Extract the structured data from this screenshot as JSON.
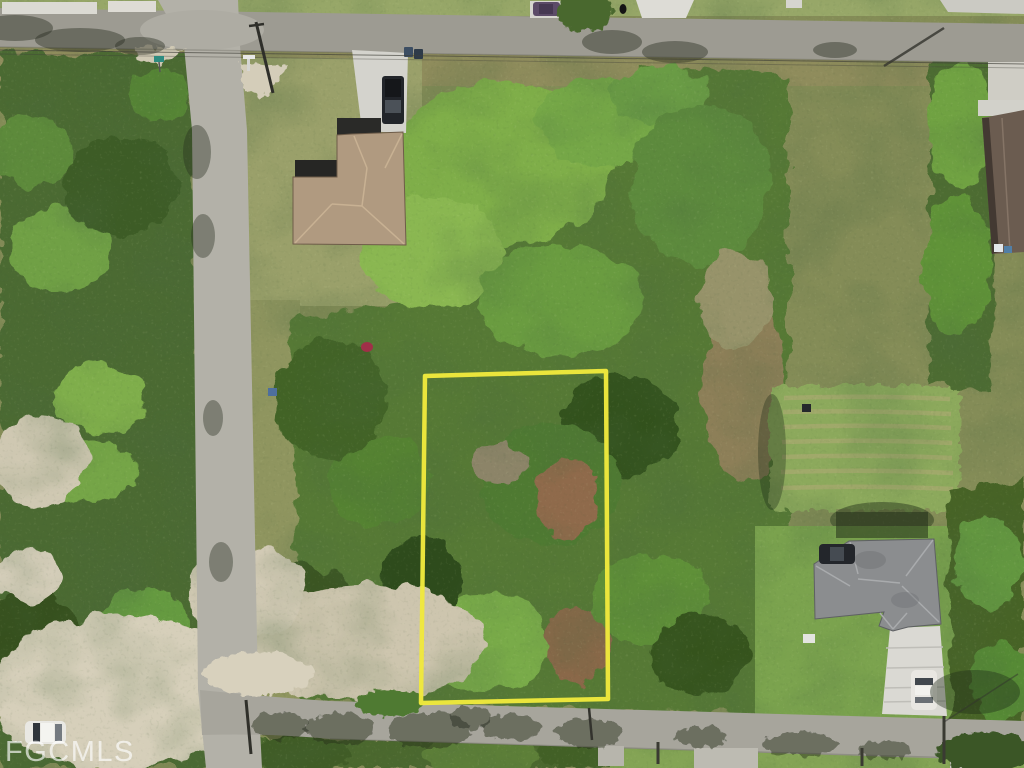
{
  "photo": {
    "watermark_text": "FGCMLS",
    "caption": "Aerial drone view of a wooded vacant residential lot outlined in yellow between two streets"
  },
  "boundary": {
    "label": "highlighted lot boundary",
    "color": "#f0e83d"
  },
  "colors": {
    "watermark": "#ffffff"
  },
  "scene": {
    "roads": [
      "street-top",
      "street-left",
      "street-bottom"
    ],
    "houses": [
      "tan-roof-house",
      "gray-roof-house",
      "partial-house-top-right"
    ],
    "vehicles": [
      "dark-pickup-truck",
      "white-car-driveway",
      "white-car-roadside",
      "dark-suv",
      "purple-car"
    ],
    "ground": [
      "dense-trees",
      "mowed-field",
      "sandy-intersection",
      "lawns"
    ]
  }
}
